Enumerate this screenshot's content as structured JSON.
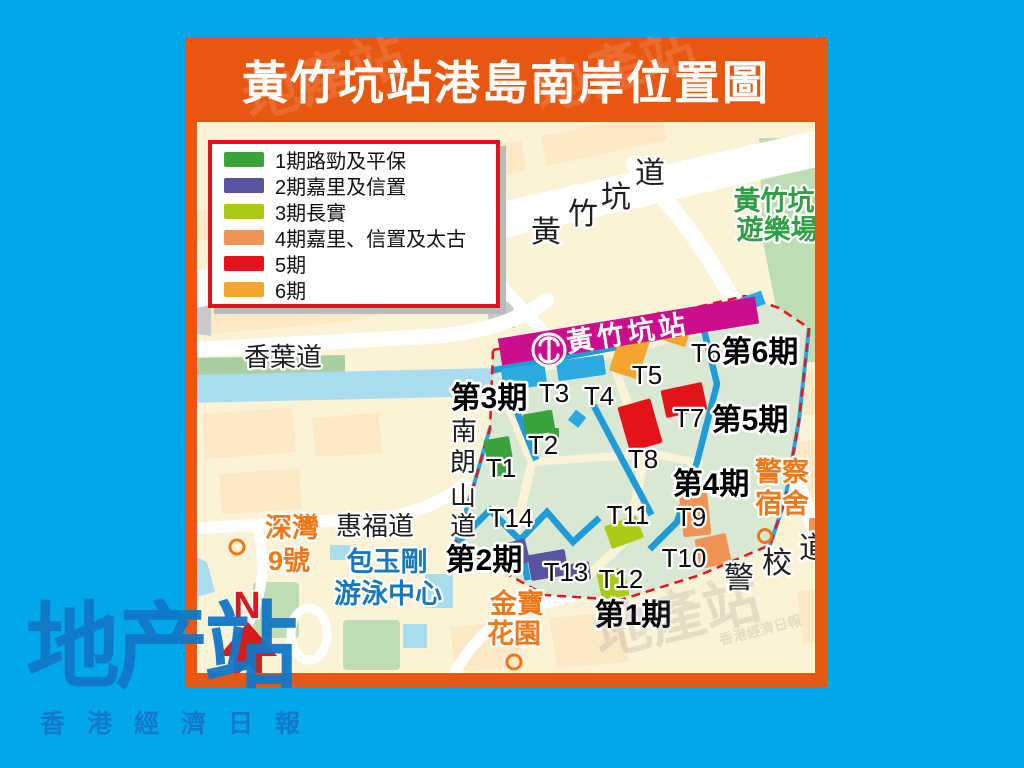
{
  "background_color": "#00a7e9",
  "watermark_text": "地產站",
  "panel": {
    "title": "黃竹坑站港島南岸位置圖",
    "border_color": "#e8570f"
  },
  "legend": {
    "items": [
      {
        "label": "1期路勁及平保",
        "color": "#3ba33b"
      },
      {
        "label": "2期嘉里及信置",
        "color": "#5954a2"
      },
      {
        "label": "3期長實",
        "color": "#a9cb13"
      },
      {
        "label": "4期嘉里、信置及太古",
        "color": "#f09355"
      },
      {
        "label": "5期",
        "color": "#e61219"
      },
      {
        "label": "6期",
        "color": "#f3a52e"
      }
    ]
  },
  "map": {
    "station": {
      "name": "黃竹坑站",
      "band_color": "#cb0e8c"
    },
    "phases": [
      "第1期",
      "第2期",
      "第3期",
      "第4期",
      "第5期",
      "第6期"
    ],
    "towers": [
      "T1",
      "T2",
      "T3",
      "T4",
      "T5",
      "T6",
      "T7",
      "T8",
      "T9",
      "T10",
      "T11",
      "T12",
      "T13",
      "T14"
    ],
    "cyan_tower_color": "#29abe2",
    "boundary_color": "#e8141c",
    "internal_road_color": "#1f9cd8",
    "water_color": "#aadcf0",
    "park_color": "#bfddb4",
    "roads": {
      "wong_chuk_hang_road": {
        "name": "黃竹坑道",
        "chars": [
          "黃",
          "竹",
          "坑",
          "道"
        ]
      },
      "heung_yip_road": {
        "name": "香葉道"
      },
      "nam_long_shan_road": {
        "name": "南朗山道",
        "chars": [
          "南",
          "朗",
          "山",
          "道"
        ]
      },
      "wai_fuk_road": {
        "name": "惠福道"
      },
      "police_school_road": {
        "name": "警校道",
        "chars": [
          "警",
          "校",
          "道"
        ]
      }
    },
    "places": {
      "playground": {
        "name": "黃竹坑遊樂場",
        "lines": [
          "黃竹坑",
          "遊樂場"
        ],
        "color": "#2f9e45"
      },
      "sham_wan_9": {
        "name": "深灣9號",
        "lines": [
          "深灣",
          "9號"
        ],
        "color": "#f07818"
      },
      "pao_yue_kong_pool": {
        "name": "包玉剛游泳中心",
        "lines": [
          "包玉剛",
          "游泳中心"
        ],
        "color": "#1878be"
      },
      "kampo_garden": {
        "name": "金寶花園",
        "lines": [
          "金寶",
          "花園"
        ],
        "color": "#f07818"
      },
      "police_quarters": {
        "name": "警察宿舍",
        "lines": [
          "警察",
          "宿舍"
        ],
        "color": "#f07818"
      }
    },
    "compass": {
      "label": "N",
      "color": "#d81a1c"
    }
  },
  "logo": {
    "text": "地产站",
    "subtext": "香港經濟日報",
    "color": "#1277c9"
  }
}
